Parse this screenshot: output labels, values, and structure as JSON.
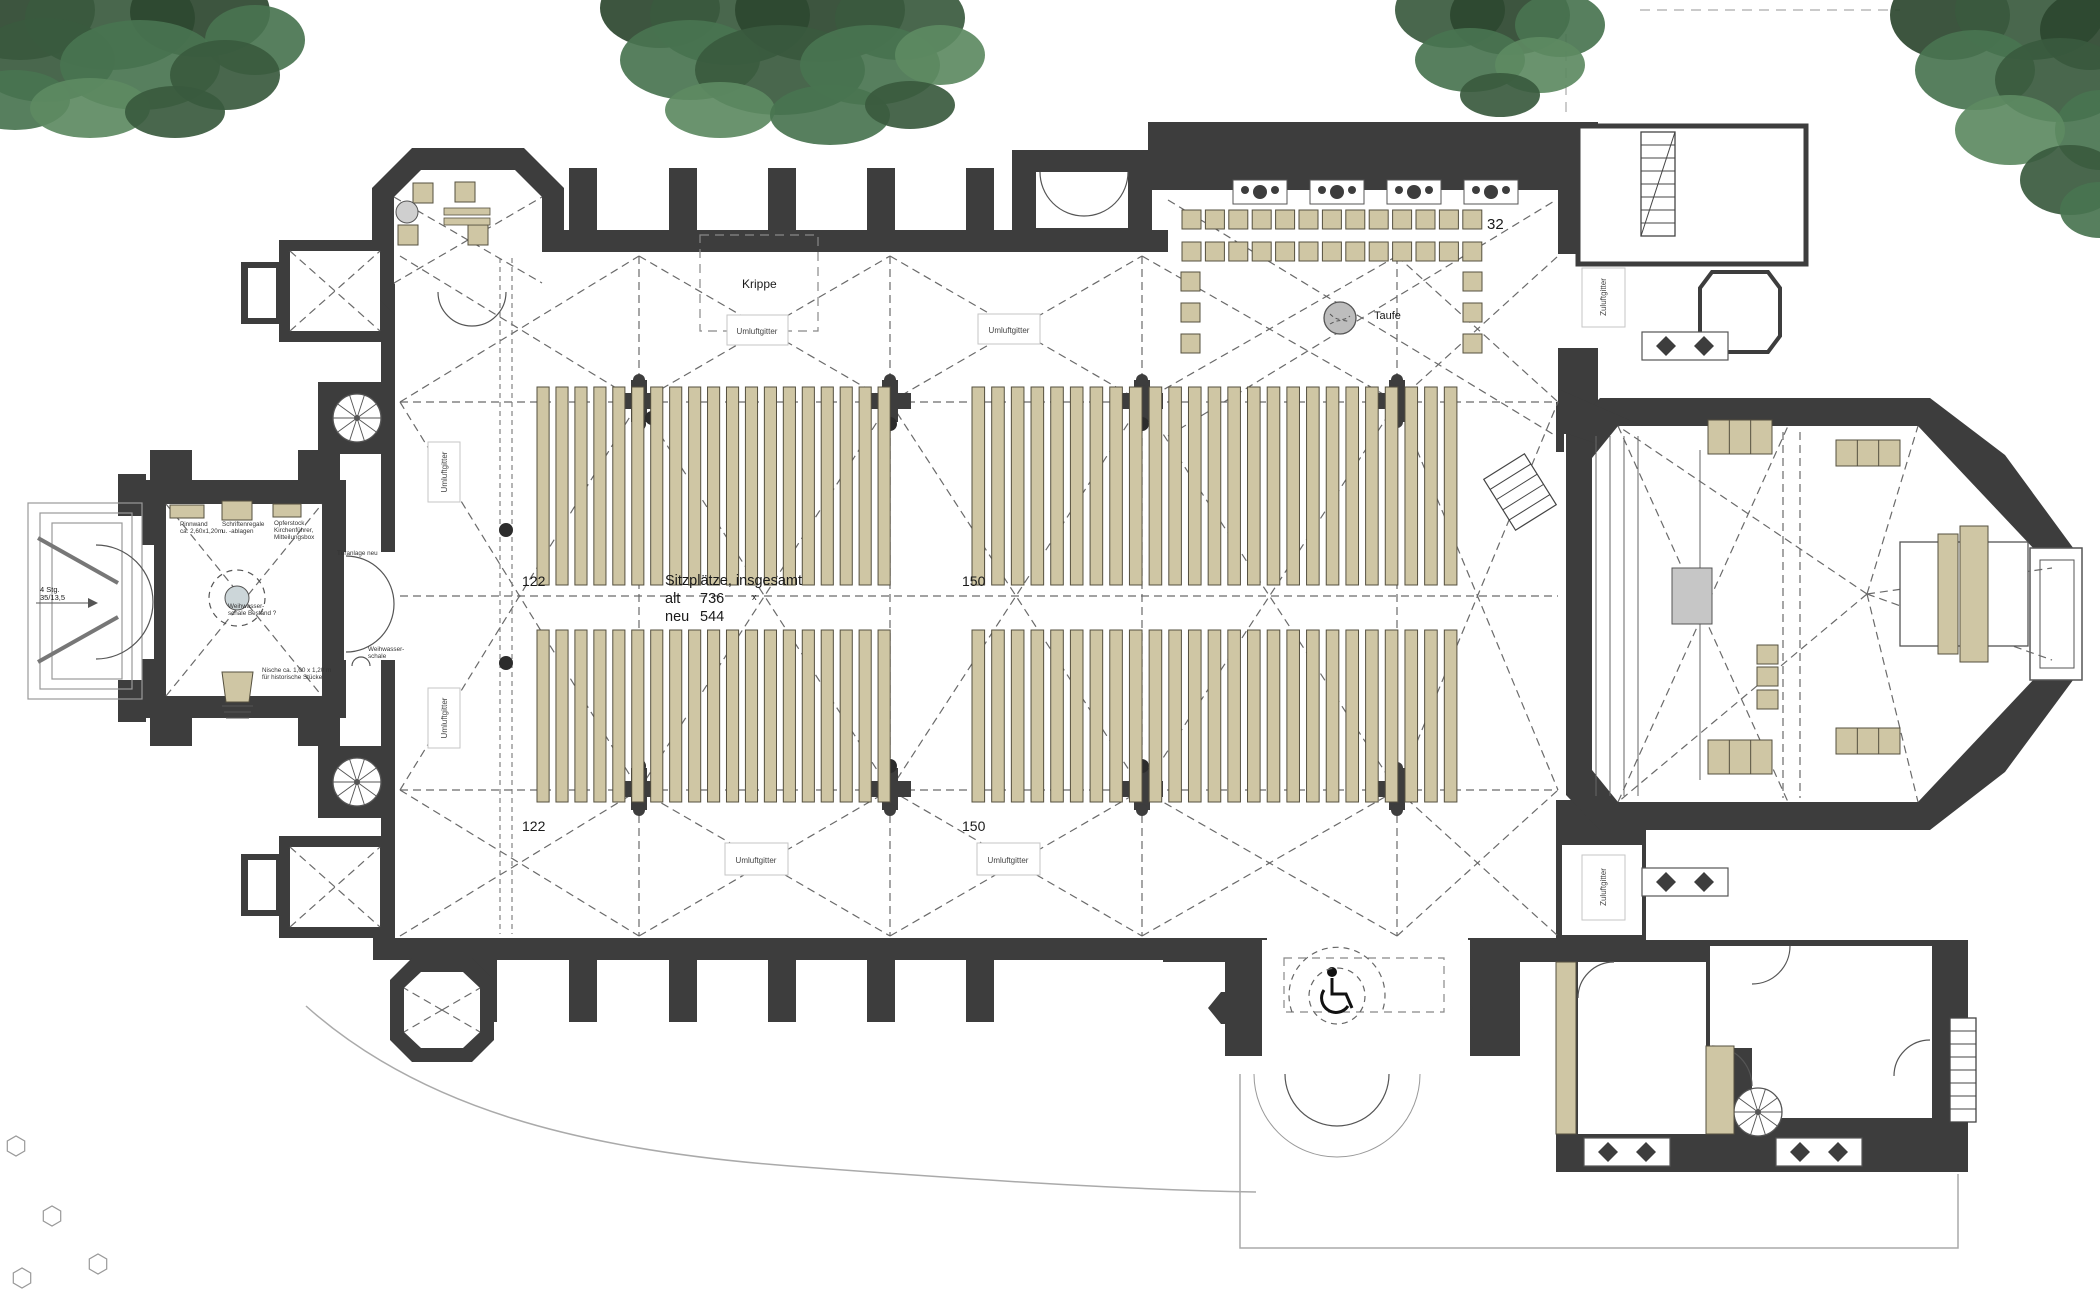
{
  "seating": {
    "summary_title": "Sitzplätze, insgesamt",
    "alt_label": "alt",
    "alt_value": "736",
    "neu_label": "neu",
    "neu_value": "544",
    "center_mark": "x",
    "left_block_count": "122",
    "right_block_count": "150",
    "chapel_count": "32"
  },
  "labels": {
    "taufe": "Taufe",
    "krippe": "Krippe",
    "umluftgitter": "Umluftgitter",
    "zuluftgitter": "Zuluftgitter",
    "tueranlage_neu": "Türanlage neu",
    "stairs_line1": "4 Stg.",
    "stairs_line2": "35/13,5"
  },
  "annotations": {
    "pinnwand_l1": "Pinnwand",
    "pinnwand_l2": "ca. 2,60x1,20m",
    "schriftenregale_l1": "Schriftenregale",
    "schriftenregale_l2": "u. -ablagen",
    "opferstock_l1": "Opferstock,",
    "opferstock_l2": "Kirchenführer,",
    "opferstock_l3": "Mitteilungsbox",
    "weihwasser_bestand_l1": "Weihwasser-",
    "weihwasser_bestand_l2": "schale Bestand ?",
    "weihwasser_l1": "Weihwasser-",
    "weihwasser_l2": "schale",
    "nische_l1": "Nische ca. 1,00 x 1,20 m",
    "nische_l2": "für historische Stücke"
  },
  "icons": {
    "wheelchair": "wheelchair-access-symbol"
  },
  "colors": {
    "wall": "#3d3d3d",
    "pew": "#cfc6a4",
    "pew_stroke": "#55503f",
    "floor": "#ffffff",
    "font_gray": "#bdbdbd",
    "ambo_gray": "#c6c6c6",
    "rib": "#6a6a6a",
    "site_line": "#aaaaaa",
    "tree_greens": [
      "#2c462f",
      "#3a5a3e",
      "#497450",
      "#5d8a62"
    ]
  }
}
